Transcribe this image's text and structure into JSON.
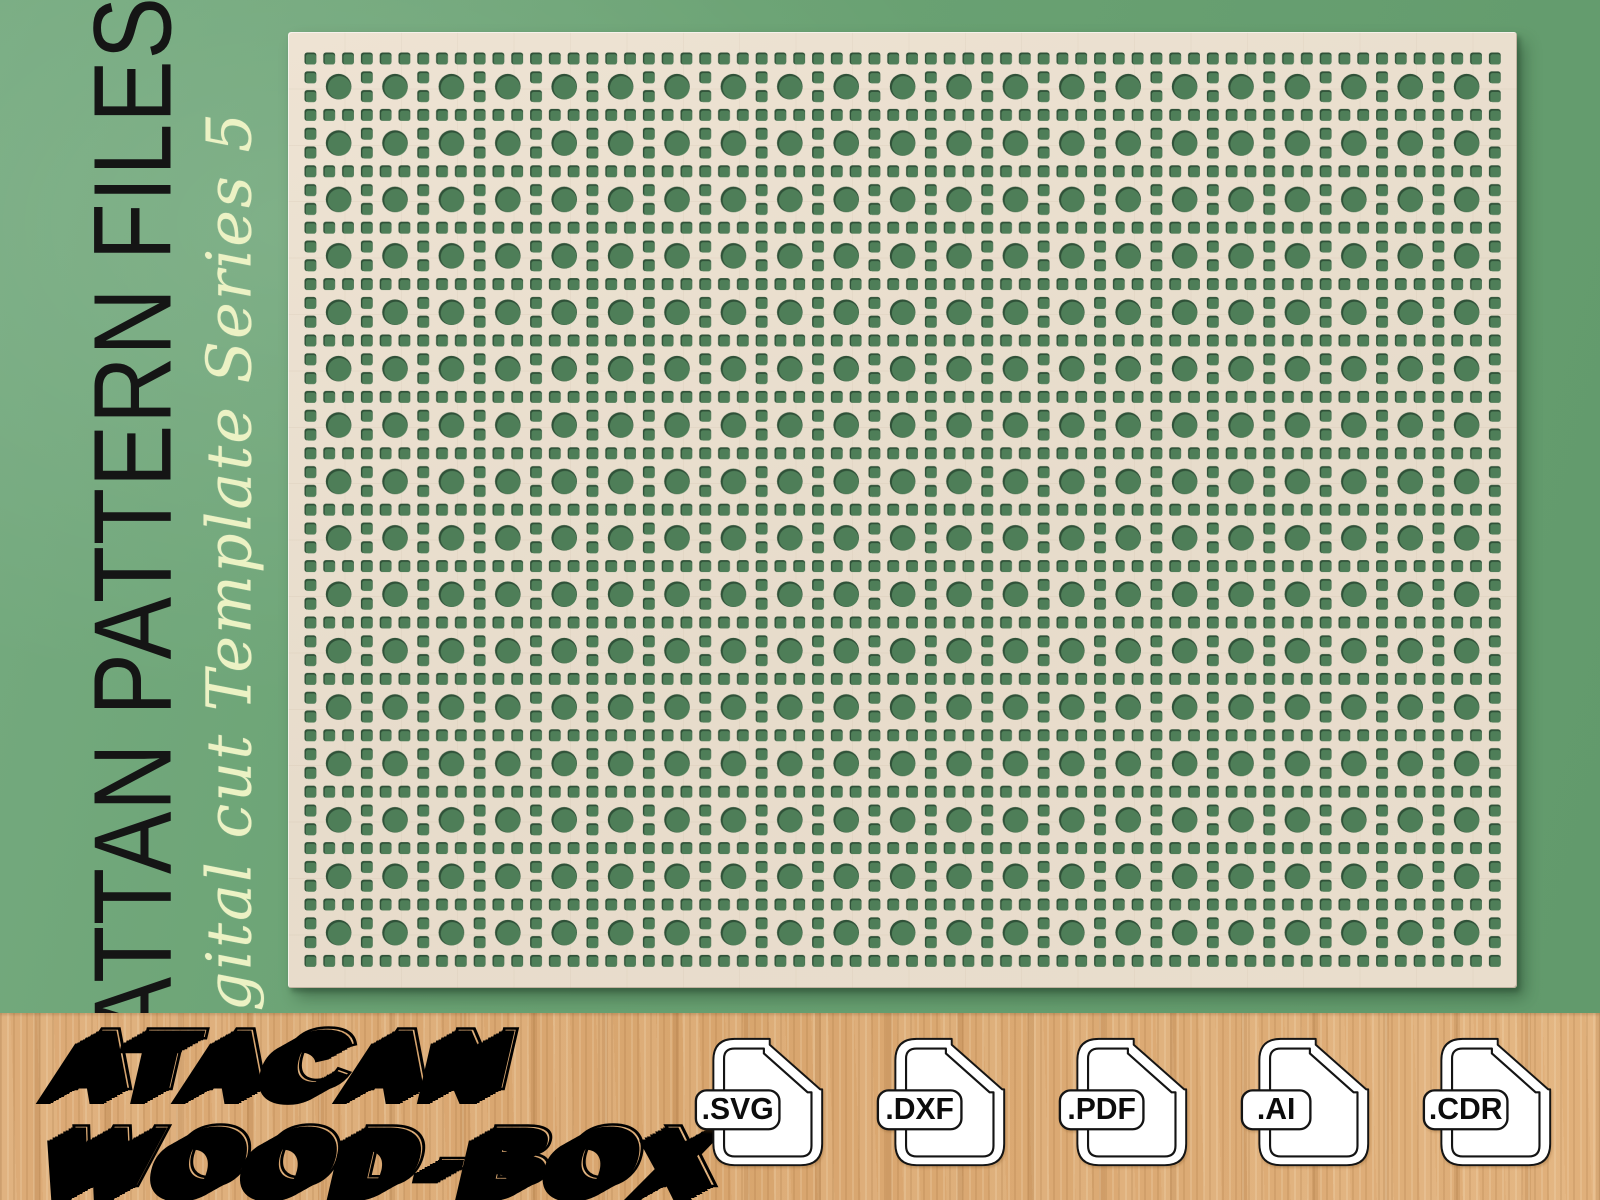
{
  "hero": {
    "title": "RATTAN PATTERN FILES",
    "subtitle": "Digital cut Template Series 5"
  },
  "panel": {
    "pattern_name": "rattan-cane-webbing-grid",
    "hole_shapes": [
      "circle",
      "square"
    ]
  },
  "footer": {
    "logo_line1": "ATACAN",
    "logo_line2": "WOOD-BOX",
    "file_badges": [
      ".SVG",
      ".DXF",
      ".PDF",
      ".AI",
      ".CDR"
    ]
  },
  "colors": {
    "background_green": "#6aa273",
    "panel_beige": "#e7dccb",
    "hole_green": "#4e7e58",
    "hole_shadow": "#2f5138",
    "wood_tan": "#dcab77",
    "subtitle_cream": "#ecf2c4",
    "title_black": "#151515"
  }
}
